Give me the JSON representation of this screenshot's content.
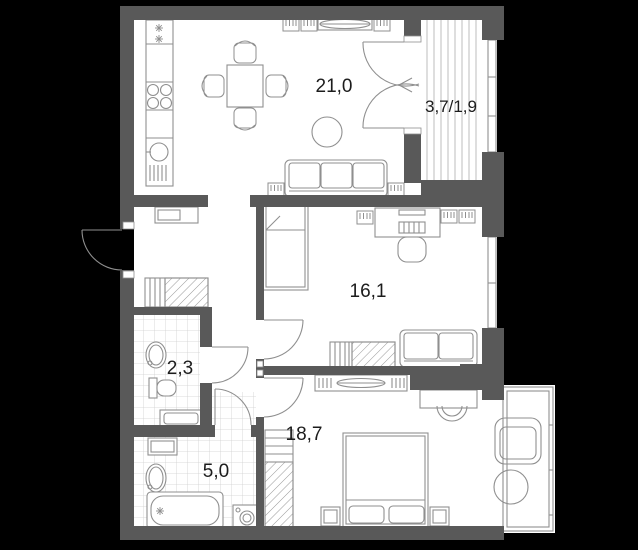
{
  "plan_title": "apartment-floor-plan",
  "rooms": {
    "living_kitchen": {
      "label": "21,0"
    },
    "balcony": {
      "label": "3,7/1,9"
    },
    "bedroom_small": {
      "label": "16,1"
    },
    "wc": {
      "label": "2,3"
    },
    "bedroom_master": {
      "label": "18,7"
    },
    "bathroom": {
      "label": "5,0"
    }
  },
  "symbols": [
    "fridge",
    "stove",
    "kitchen-sink",
    "dining-table",
    "dining-chair",
    "tv-stand",
    "radiator-grille",
    "sofa-3-seat",
    "ottoman",
    "french-balcony-door",
    "entrance-door",
    "single-bed",
    "desk",
    "desk-chair",
    "sofa-2-seat",
    "wardrobe",
    "wash-basin",
    "toilet",
    "bathtub",
    "washing-machine",
    "double-bed",
    "nightstand",
    "armchair",
    "pouf",
    "window",
    "bay-window"
  ],
  "colors": {
    "background": "#000000",
    "wall": "#595959",
    "floor": "#ffffff",
    "furniture_line": "#8f8f8f",
    "tile_line": "#cfcfcf",
    "hatch_line": "#9a9a9a",
    "stripe_line": "#bcbcbc",
    "label_text": "#1c1c1c"
  }
}
